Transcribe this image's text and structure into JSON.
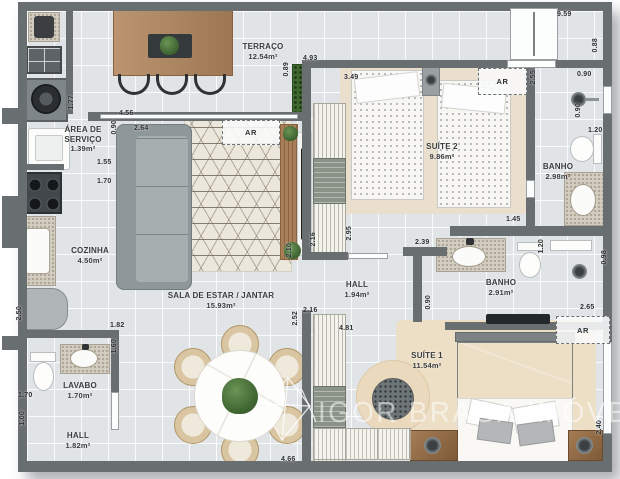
{
  "watermark": {
    "text": "IGOR BRAGA IMÓVEIS"
  },
  "rooms": [
    {
      "label": "TERRAÇO",
      "area": "12.54m²",
      "x": 263,
      "y": 42,
      "w": 90
    },
    {
      "label": "ÁREA DE SERVIÇO",
      "area": "1.39m²",
      "x": 83,
      "y": 125,
      "w": 56
    },
    {
      "label": "COZINHA",
      "area": "4.50m²",
      "x": 90,
      "y": 246,
      "w": 70
    },
    {
      "label": "SALA DE ESTAR / JANTAR",
      "area": "15.93m²",
      "x": 221,
      "y": 291,
      "w": 170
    },
    {
      "label": "LAVABO",
      "area": "1.70m²",
      "x": 80,
      "y": 381,
      "w": 60
    },
    {
      "label": "HALL",
      "area": "1.82m²",
      "x": 78,
      "y": 431,
      "w": 60
    },
    {
      "label": "HALL",
      "area": "1.94m²",
      "x": 357,
      "y": 280,
      "w": 60
    },
    {
      "label": "BANHO",
      "area": "2.91m²",
      "x": 501,
      "y": 278,
      "w": 60
    },
    {
      "label": "SUÍTE 1",
      "area": "11.54m²",
      "x": 427,
      "y": 351,
      "w": 70
    },
    {
      "label": "SUÍTE 2",
      "area": "9.86m²",
      "x": 442,
      "y": 142,
      "w": 70
    },
    {
      "label": "BANHO",
      "area": "2.98m²",
      "x": 558,
      "y": 162,
      "w": 60
    }
  ],
  "dimensions": [
    {
      "v": "9.59",
      "x": 557,
      "y": 10
    },
    {
      "v": "0.90",
      "x": 577,
      "y": 70
    },
    {
      "v": "1.20",
      "x": 588,
      "y": 126
    },
    {
      "v": "4.93",
      "x": 303,
      "y": 54
    },
    {
      "v": "3.49",
      "x": 344,
      "y": 73
    },
    {
      "v": "4.56",
      "x": 119,
      "y": 109
    },
    {
      "v": "2.64",
      "x": 134,
      "y": 124
    },
    {
      "v": "1.55",
      "x": 97,
      "y": 158
    },
    {
      "v": "1.70",
      "x": 97,
      "y": 177
    },
    {
      "v": "1.45",
      "x": 506,
      "y": 215
    },
    {
      "v": "2.39",
      "x": 415,
      "y": 238
    },
    {
      "v": "2.65",
      "x": 580,
      "y": 303
    },
    {
      "v": "2.16",
      "x": 303,
      "y": 306
    },
    {
      "v": "4.81",
      "x": 339,
      "y": 324
    },
    {
      "v": "1.82",
      "x": 110,
      "y": 321
    },
    {
      "v": "1.70",
      "x": 18,
      "y": 391
    },
    {
      "v": "4.66",
      "x": 281,
      "y": 455
    },
    {
      "v": "1.77",
      "x": 67,
      "y": 95,
      "vert": true
    },
    {
      "v": "0.90",
      "x": 110,
      "y": 120,
      "vert": true
    },
    {
      "v": "0.89",
      "x": 282,
      "y": 62,
      "vert": true
    },
    {
      "v": "2.55",
      "x": 529,
      "y": 70,
      "vert": true
    },
    {
      "v": "0.88",
      "x": 591,
      "y": 38,
      "vert": true
    },
    {
      "v": "0.90",
      "x": 574,
      "y": 103,
      "vert": true
    },
    {
      "v": "2.95",
      "x": 345,
      "y": 226,
      "vert": true
    },
    {
      "v": "2.16",
      "x": 309,
      "y": 232,
      "vert": true
    },
    {
      "v": "2.10",
      "x": 285,
      "y": 243,
      "vert": true
    },
    {
      "v": "2.50",
      "x": 15,
      "y": 306,
      "vert": true
    },
    {
      "v": "1.60",
      "x": 110,
      "y": 339,
      "vert": true
    },
    {
      "v": "1.00",
      "x": 18,
      "y": 411,
      "vert": true
    },
    {
      "v": "2.52",
      "x": 291,
      "y": 311,
      "vert": true
    },
    {
      "v": "0.90",
      "x": 424,
      "y": 295,
      "vert": true
    },
    {
      "v": "1.20",
      "x": 537,
      "y": 239,
      "vert": true
    },
    {
      "v": "0.98",
      "x": 600,
      "y": 250,
      "vert": true
    },
    {
      "v": "2.40",
      "x": 595,
      "y": 420,
      "vert": true
    }
  ],
  "ar_units": [
    {
      "label": "AR",
      "x": 222,
      "y": 120,
      "w": 56,
      "h": 23
    },
    {
      "label": "AR",
      "x": 478,
      "y": 68,
      "w": 47,
      "h": 25
    },
    {
      "label": "AR",
      "x": 556,
      "y": 316,
      "w": 52,
      "h": 26
    }
  ],
  "colors": {
    "wall": "#696e70",
    "floor": "#e0e4e7",
    "wood": "#bb9470",
    "rug": "#ece7dc",
    "suite_rug": "#ead9bd",
    "green": "#47703c"
  }
}
